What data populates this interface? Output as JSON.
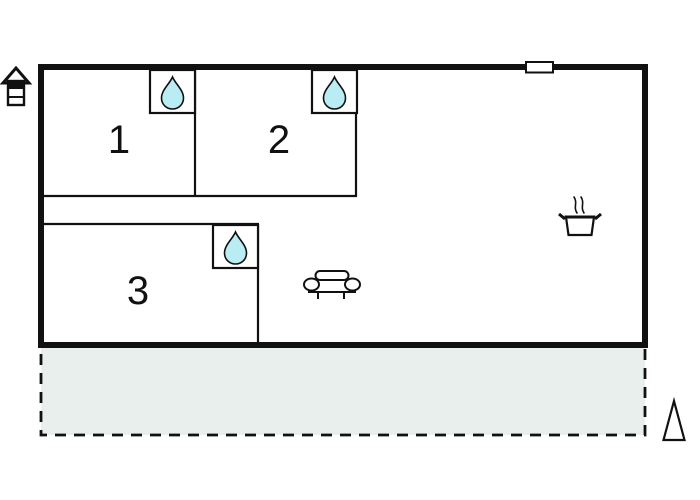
{
  "floorplan": {
    "type": "vacation-home-floor-plan",
    "rooms": [
      {
        "label": "1"
      },
      {
        "label": "2"
      },
      {
        "label": "3"
      }
    ],
    "colors": {
      "wall": "#111111",
      "room_fill": "#ffffff",
      "droplet_fill": "#b9edf3",
      "terrace_fill": "#e9efed",
      "background": "#ffffff"
    },
    "icons": [
      "house-icon",
      "water-drop-icon",
      "window-marker",
      "sofa-icon",
      "cooking-pot-icon",
      "north-arrow-icon"
    ]
  }
}
